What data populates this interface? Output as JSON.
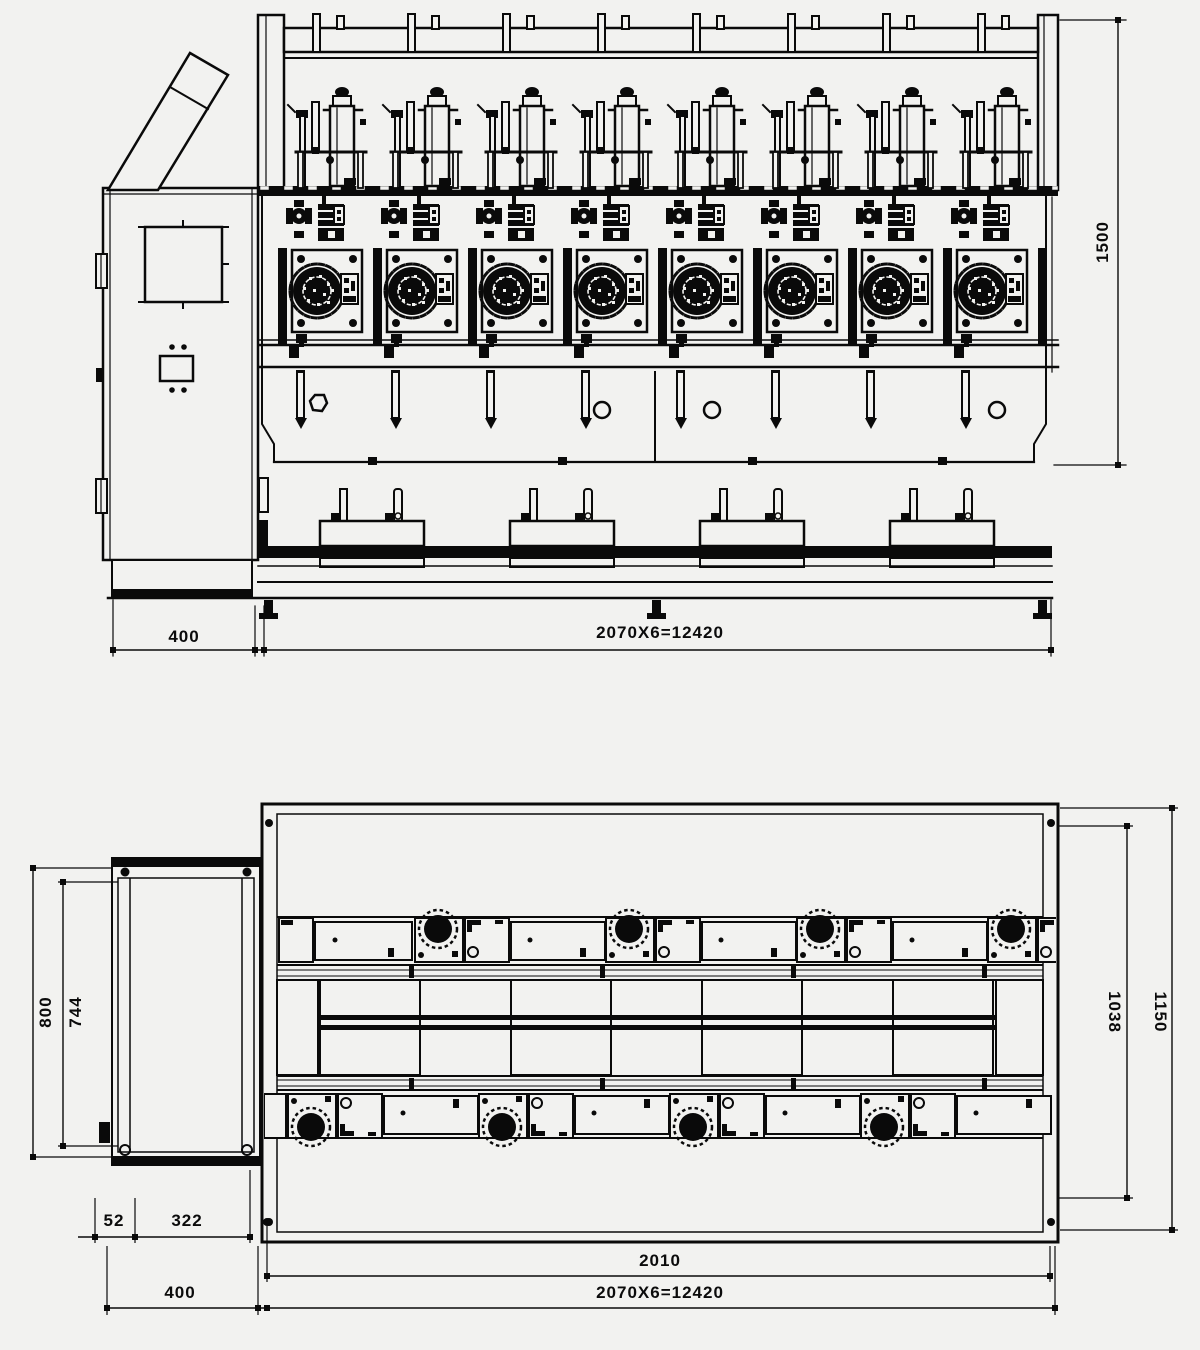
{
  "drawing": {
    "background": "#f2f2f0",
    "line_color": "#0a0a0a",
    "front_view": {
      "unit_count": 8,
      "trough_count": 4,
      "dims": {
        "cabinet_width": "400",
        "total_length": "2070X6=12420",
        "height": "1500"
      }
    },
    "plan_view": {
      "module_group_count": 4,
      "middle_box_count": 4,
      "door_tab_count": 4,
      "dims": {
        "offset": "52",
        "cabinet_width": "322",
        "cabinet_depth": "400",
        "body_width": "2010",
        "total_length": "2070X6=12420",
        "cabinet_inner_height": "744",
        "cabinet_outer_height": "800",
        "inner_depth": "1038",
        "outer_depth": "1150"
      }
    }
  }
}
